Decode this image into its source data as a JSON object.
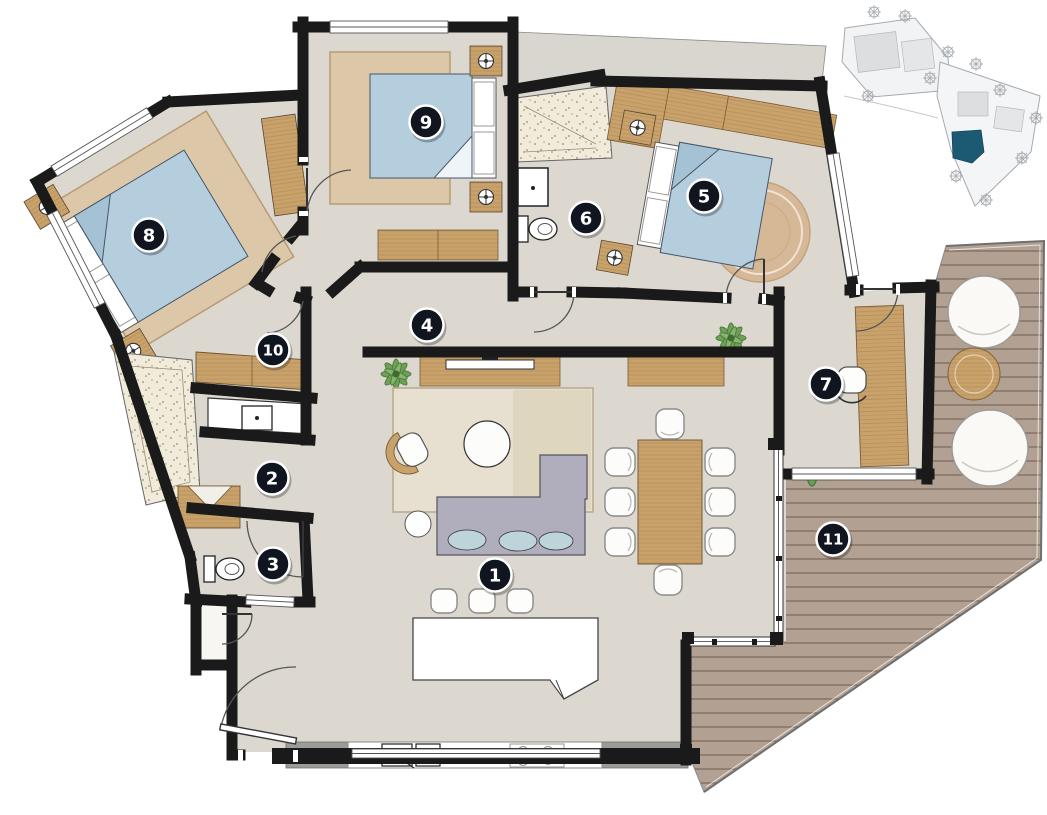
{
  "plan": {
    "type": "apartment-floor-plan",
    "markers": [
      {
        "label": "1",
        "x": 495,
        "y": 575
      },
      {
        "label": "2",
        "x": 272,
        "y": 478
      },
      {
        "label": "3",
        "x": 273,
        "y": 564
      },
      {
        "label": "4",
        "x": 427,
        "y": 325
      },
      {
        "label": "5",
        "x": 704,
        "y": 196
      },
      {
        "label": "6",
        "x": 586,
        "y": 218
      },
      {
        "label": "7",
        "x": 826,
        "y": 384
      },
      {
        "label": "8",
        "x": 149,
        "y": 235
      },
      {
        "label": "9",
        "x": 426,
        "y": 122
      },
      {
        "label": "10",
        "x": 273,
        "y": 350
      },
      {
        "label": "11",
        "x": 833,
        "y": 539
      }
    ]
  },
  "palette": {
    "background": "#ffffff",
    "wall": "#1a1a1a",
    "floor": "#dcd8d0",
    "wood": "#c9a26b",
    "rug": "#dcc7a8",
    "bed": "#b5cede",
    "sofa": "#b0aebc",
    "deck": "#b2a193",
    "shower_floor": "#f1ebdc",
    "window": "#ffffff",
    "marker_bg": "#10151f",
    "marker_ring": "#ffffff",
    "siteplan_highlight": "#1c5a74"
  }
}
